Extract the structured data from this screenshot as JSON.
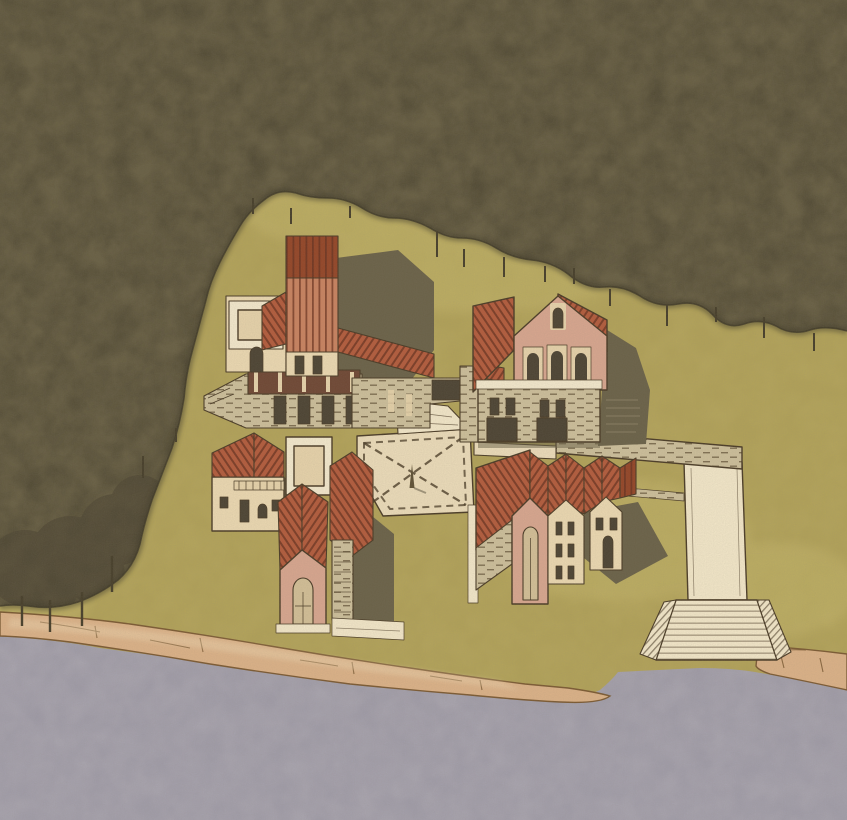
{
  "scene": {
    "kind": "watercolor axonometric site illustration",
    "elements": [
      "forest-mass",
      "meadow-clearing",
      "upper-left-building-cluster",
      "upper-right-villa",
      "lower-left-chapel-cluster",
      "row-houses",
      "central-plaza-with-crossing-paths",
      "obelisk",
      "promenade-wall",
      "ramp-to-water",
      "flared-stair",
      "rocky-shoreline",
      "water"
    ],
    "text_content": ""
  },
  "palette": {
    "ink": "#4a3b26",
    "grass": "#b1a158",
    "grass_light": "#c9ba6e",
    "forest": "#685f44",
    "forest_dark": "#3e3827",
    "forest_crown": "#4e4633",
    "trunk": "#463e2a",
    "water": "#a8a4af",
    "water_mottle": "#8f8b9b",
    "shore": "#dcb288",
    "shore_light": "#efd8b2",
    "rock_line": "#7c5a33",
    "roof_red": "#b35b3c",
    "roof_line": "#6e3420",
    "roof_salmon": "#c98260",
    "roof_dark": "#944527",
    "wall_cream": "#ecd9b2",
    "wall_pink": "#d8a68f",
    "wall_white": "#f4e9cd",
    "frame_light": "#e7d3ab",
    "stone": "#cdbf9b",
    "stone_line": "#6b5b40",
    "opening": "#4c4333",
    "shadow": "#6a6148",
    "shadow_dark": "#574f3b",
    "path": "#ecdcba",
    "path_light": "#f3e7c9",
    "glass": "#d3bf97",
    "obelisk": "#5f5136",
    "grain_dark": "#3a3322",
    "grain_light": "#fff8e8"
  }
}
